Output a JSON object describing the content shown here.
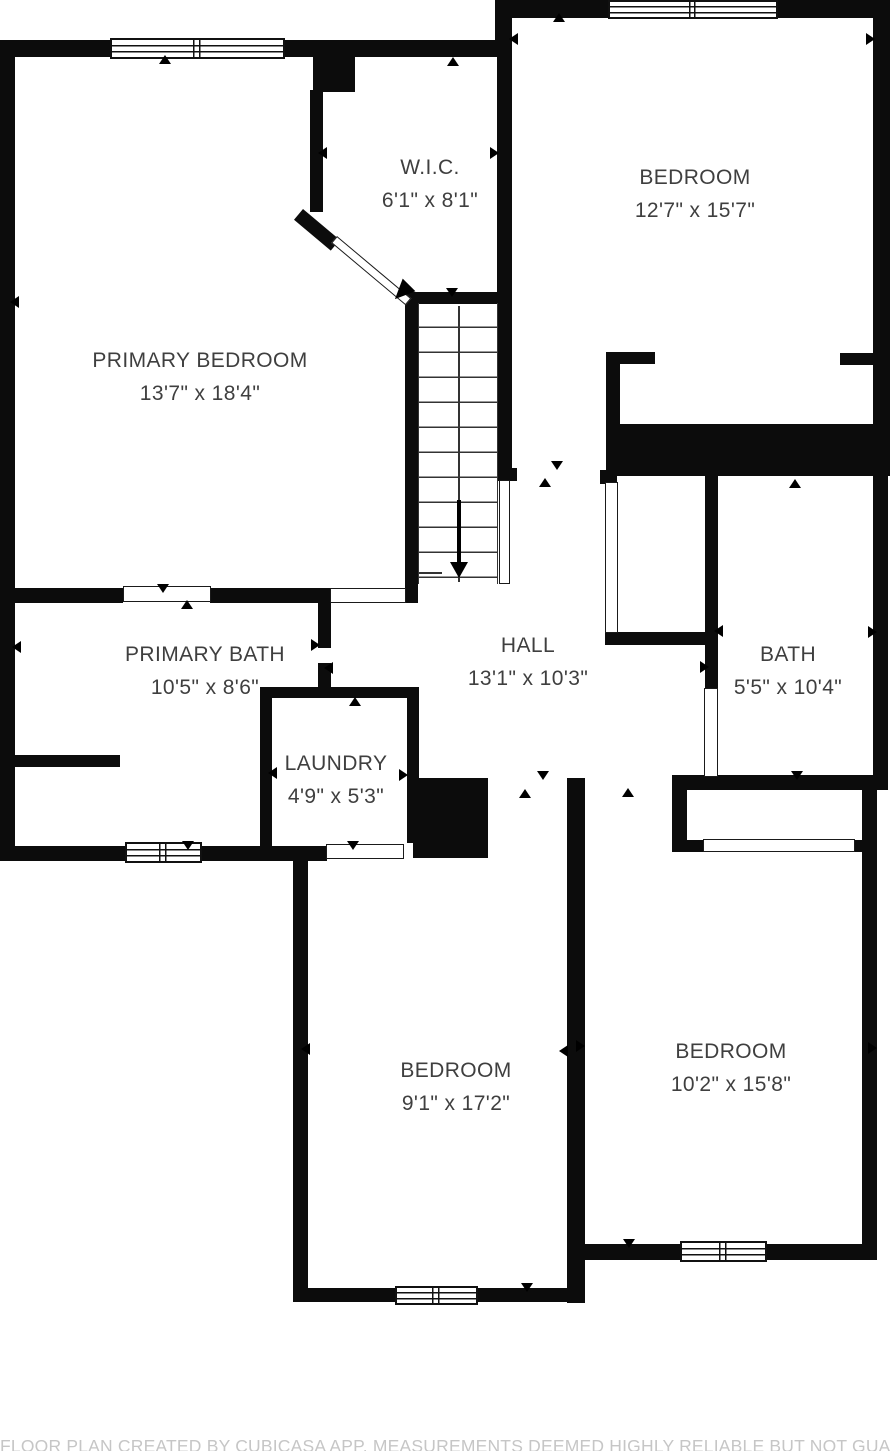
{
  "title": "Floor plan",
  "colors": {
    "wall": "#0c0c0c",
    "room_label": "#3f3f3f",
    "footer_text": "#c6c6c6",
    "background": "#ffffff"
  },
  "rooms": [
    {
      "id": "primary-bedroom",
      "name": "PRIMARY BEDROOM",
      "dims": "13'7\" x 18'4\""
    },
    {
      "id": "wic",
      "name": "W.I.C.",
      "dims": "6'1\" x 8'1\""
    },
    {
      "id": "bedroom-top-right",
      "name": "BEDROOM",
      "dims": "12'7\" x 15'7\""
    },
    {
      "id": "primary-bath",
      "name": "PRIMARY BATH",
      "dims": "10'5\" x 8'6\""
    },
    {
      "id": "hall",
      "name": "HALL",
      "dims": "13'1\" x 10'3\""
    },
    {
      "id": "bath",
      "name": "BATH",
      "dims": "5'5\" x 10'4\""
    },
    {
      "id": "laundry",
      "name": "LAUNDRY",
      "dims": "4'9\" x 5'3\""
    },
    {
      "id": "bedroom-bottom-left",
      "name": "BEDROOM",
      "dims": "9'1\" x 17'2\""
    },
    {
      "id": "bedroom-bottom-right",
      "name": "BEDROOM",
      "dims": "10'2\" x 15'8\""
    }
  ],
  "footer": {
    "text": "FLOOR PLAN CREATED BY CUBICASA APP. MEASUREMENTS DEEMED HIGHLY RELIABLE BUT NOT GUARANTEED."
  }
}
